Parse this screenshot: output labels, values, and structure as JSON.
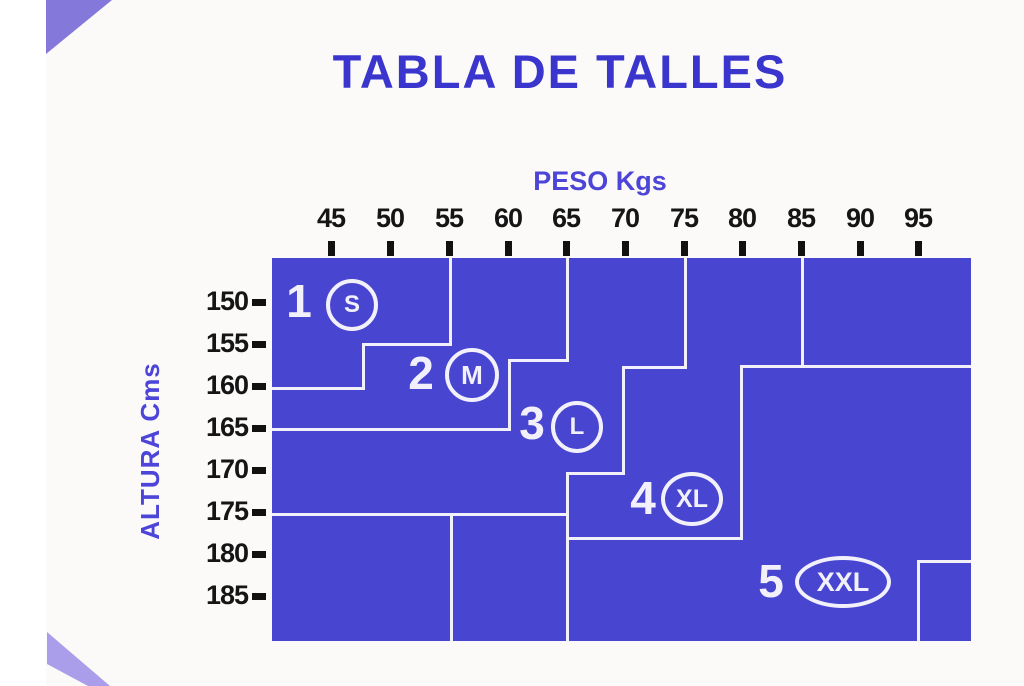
{
  "title": "TABLA DE TALLES",
  "axes": {
    "weight_label": "PESO Kgs",
    "height_label": "ALTURA Cms",
    "weight_ticks_kg": [
      45,
      50,
      55,
      60,
      65,
      70,
      75,
      80,
      85,
      90,
      95
    ],
    "height_ticks_cm": [
      150,
      155,
      160,
      165,
      170,
      175,
      180,
      185
    ]
  },
  "colors": {
    "chart_fill": "#4845d1",
    "boundary_line": "#f2f1fb",
    "title_text": "#3a35cd",
    "axis_label_text": "#4c45d7",
    "tick_text": "#151515",
    "deco_triangle": "#8478da",
    "deco_stripe": "#aa9de9",
    "page_background": "#fbfaf8"
  },
  "chart_data": {
    "type": "area",
    "title": "TABLA DE TALLES",
    "xlabel": "PESO Kgs",
    "ylabel": "ALTURA Cms",
    "x_ticks": [
      45,
      50,
      55,
      60,
      65,
      70,
      75,
      80,
      85,
      90,
      95
    ],
    "y_ticks": [
      150,
      155,
      160,
      165,
      170,
      175,
      180,
      185
    ],
    "x_range_kg": [
      40,
      99
    ],
    "y_range_cm": [
      145,
      190
    ],
    "grid": false,
    "legend": "none",
    "regions": [
      {
        "number": "1",
        "size": "S",
        "weight_kg": [
          45,
          55
        ],
        "height_cm": [
          150,
          160
        ],
        "lower_boundary_steps_kg_cm": [
          [
            40,
            160
          ],
          [
            47.5,
            160
          ],
          [
            47.5,
            155
          ],
          [
            55,
            155
          ],
          [
            55,
            145
          ]
        ]
      },
      {
        "number": "2",
        "size": "M",
        "weight_kg": [
          47,
          65
        ],
        "height_cm": [
          155,
          165
        ],
        "lower_boundary_steps_kg_cm": [
          [
            40,
            165
          ],
          [
            60,
            165
          ],
          [
            60,
            157
          ],
          [
            65,
            157
          ],
          [
            65,
            145
          ]
        ]
      },
      {
        "number": "3",
        "size": "L",
        "weight_kg": [
          60,
          75
        ],
        "height_cm": [
          157,
          175
        ],
        "lower_boundary_steps_kg_cm": [
          [
            40,
            175
          ],
          [
            65,
            175
          ],
          [
            65,
            170
          ],
          [
            70,
            170
          ],
          [
            70,
            158
          ],
          [
            75,
            158
          ],
          [
            75,
            145
          ]
        ]
      },
      {
        "number": "4",
        "size": "XL",
        "weight_kg": [
          65,
          85
        ],
        "height_cm": [
          170,
          178
        ],
        "lower_boundary_steps_kg_cm": [
          [
            65,
            190
          ],
          [
            65,
            178
          ],
          [
            80,
            178
          ],
          [
            80,
            158
          ],
          [
            85,
            158
          ],
          [
            85,
            145
          ]
        ]
      },
      {
        "number": "5",
        "size": "XXL",
        "weight_kg": [
          65,
          95
        ],
        "height_cm": [
          178,
          190
        ],
        "lower_boundary_steps_kg_cm": [
          [
            95,
            181
          ],
          [
            95,
            190
          ]
        ]
      }
    ],
    "render": {
      "xtick_px": [
        331,
        390,
        449,
        508,
        566,
        625,
        684,
        742,
        801,
        860,
        918
      ],
      "ytick_px": [
        302,
        344,
        386,
        428,
        470,
        512,
        554,
        596
      ],
      "xtick_label_top_px": 203,
      "xtick_mark_top_px": 241,
      "ytick_label_right_px": 248,
      "ytick_mark_left_px": 252,
      "boundary_lines_px": [
        {
          "x": 177,
          "y": 0,
          "w": 3,
          "h": 87
        },
        {
          "x": 90,
          "y": 85,
          "w": 90,
          "h": 3
        },
        {
          "x": 90,
          "y": 85,
          "w": 3,
          "h": 47
        },
        {
          "x": 0,
          "y": 129,
          "w": 93,
          "h": 3
        },
        {
          "x": 294,
          "y": 0,
          "w": 3,
          "h": 103
        },
        {
          "x": 236,
          "y": 101,
          "w": 61,
          "h": 3
        },
        {
          "x": 236,
          "y": 101,
          "w": 3,
          "h": 72
        },
        {
          "x": 0,
          "y": 170,
          "w": 239,
          "h": 3
        },
        {
          "x": 412,
          "y": 0,
          "w": 3,
          "h": 110
        },
        {
          "x": 350,
          "y": 108,
          "w": 65,
          "h": 3
        },
        {
          "x": 350,
          "y": 108,
          "w": 3,
          "h": 109
        },
        {
          "x": 294,
          "y": 214,
          "w": 59,
          "h": 3
        },
        {
          "x": 294,
          "y": 214,
          "w": 3,
          "h": 169
        },
        {
          "x": 0,
          "y": 255,
          "w": 297,
          "h": 3
        },
        {
          "x": 178,
          "y": 255,
          "w": 3,
          "h": 128
        },
        {
          "x": 529,
          "y": 0,
          "w": 3,
          "h": 110
        },
        {
          "x": 468,
          "y": 107,
          "w": 231,
          "h": 3
        },
        {
          "x": 468,
          "y": 107,
          "w": 3,
          "h": 175
        },
        {
          "x": 297,
          "y": 279,
          "w": 174,
          "h": 3
        },
        {
          "x": 645,
          "y": 302,
          "w": 54,
          "h": 3
        },
        {
          "x": 645,
          "y": 302,
          "w": 3,
          "h": 81
        }
      ],
      "size_labels_px": [
        {
          "number": "1",
          "letter": "S",
          "num_cx": 27,
          "num_cy": 45,
          "circ_cx": 80,
          "circ_cy": 47,
          "rx": 26,
          "ry": 26,
          "letter_size": 24
        },
        {
          "number": "2",
          "letter": "M",
          "num_cx": 149,
          "num_cy": 117,
          "circ_cx": 200,
          "circ_cy": 117,
          "rx": 27,
          "ry": 27,
          "letter_size": 26
        },
        {
          "number": "3",
          "letter": "L",
          "num_cx": 260,
          "num_cy": 167,
          "circ_cx": 305,
          "circ_cy": 169,
          "rx": 26,
          "ry": 26,
          "letter_size": 24
        },
        {
          "number": "4",
          "letter": "XL",
          "num_cx": 371,
          "num_cy": 242,
          "circ_cx": 420,
          "circ_cy": 241,
          "rx": 31,
          "ry": 27,
          "letter_size": 25
        },
        {
          "number": "5",
          "letter": "XXL",
          "num_cx": 499,
          "num_cy": 325,
          "circ_cx": 571,
          "circ_cy": 324,
          "rx": 48,
          "ry": 26,
          "letter_size": 27
        }
      ]
    }
  }
}
